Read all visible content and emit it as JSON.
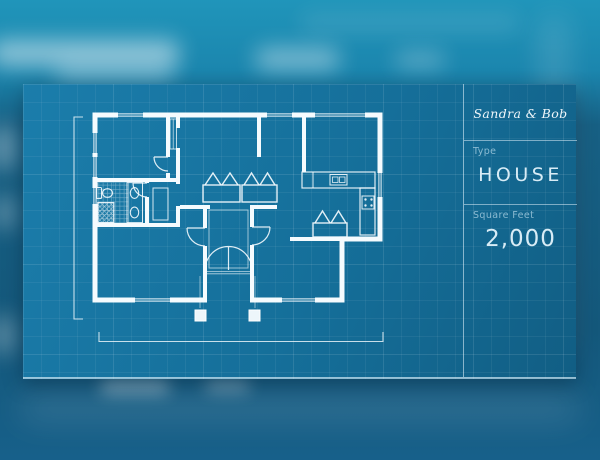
{
  "info_panel": {
    "owners_name": "Sandra & Bob",
    "type": {
      "label": "Type",
      "value": "HOUSE"
    },
    "square_feet": {
      "label": "Square Feet",
      "value": "2,000"
    }
  },
  "colors": {
    "panel_blue": "#156f9a",
    "background_teal": "#1b86ae",
    "background_dark_blue": "#14587b",
    "line_white": "#f5fbfe",
    "label_muted": "rgba(210,235,248,0.62)"
  }
}
